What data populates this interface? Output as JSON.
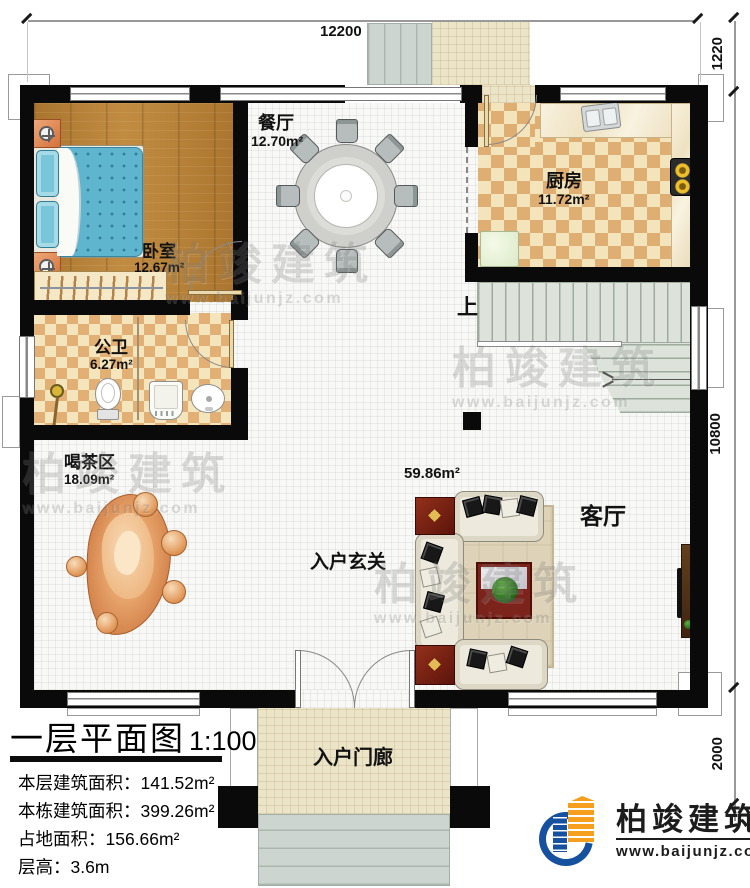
{
  "dimensions": {
    "top": "12200",
    "right_top": "1220",
    "right_middle": "10800",
    "right_bottom": "2000"
  },
  "rooms": {
    "bedroom": {
      "name": "卧室",
      "area": "12.67m²"
    },
    "dining": {
      "name": "餐厅",
      "area": "12.70m²"
    },
    "kitchen": {
      "name": "厨房",
      "area": "11.72m²"
    },
    "bathroom": {
      "name": "公卫",
      "area": "6.27m²"
    },
    "tea_area": {
      "name": "喝茶区",
      "area": "18.09m²"
    },
    "living": {
      "name": "客厅",
      "area": "59.86m²"
    },
    "foyer": {
      "name": "入户玄关"
    },
    "entry_porch": {
      "name": "入户门廊"
    }
  },
  "stairs": {
    "up_label": "上"
  },
  "title_block": {
    "title": "一层平面图",
    "scale": "1:100",
    "lines": [
      {
        "label": "本层建筑面积：",
        "value": "141.52m²"
      },
      {
        "label": "本栋建筑面积：",
        "value": "399.26m²"
      },
      {
        "label": "占地面积：",
        "value": "156.66m²"
      },
      {
        "label": "层高：",
        "value": "3.6m"
      }
    ]
  },
  "brand": {
    "name": "柏竣建筑",
    "website": "www.baijunjz.com"
  },
  "watermark": {
    "text": "柏竣建筑",
    "site": "www.baijunjz.com"
  },
  "colors": {
    "wall": "#0a0a0a",
    "wood": "#b07a33",
    "checker": "#dfae72",
    "stair": "#dde3da",
    "logo_blue": "#15519f",
    "logo_orange": "#f59f1c"
  }
}
